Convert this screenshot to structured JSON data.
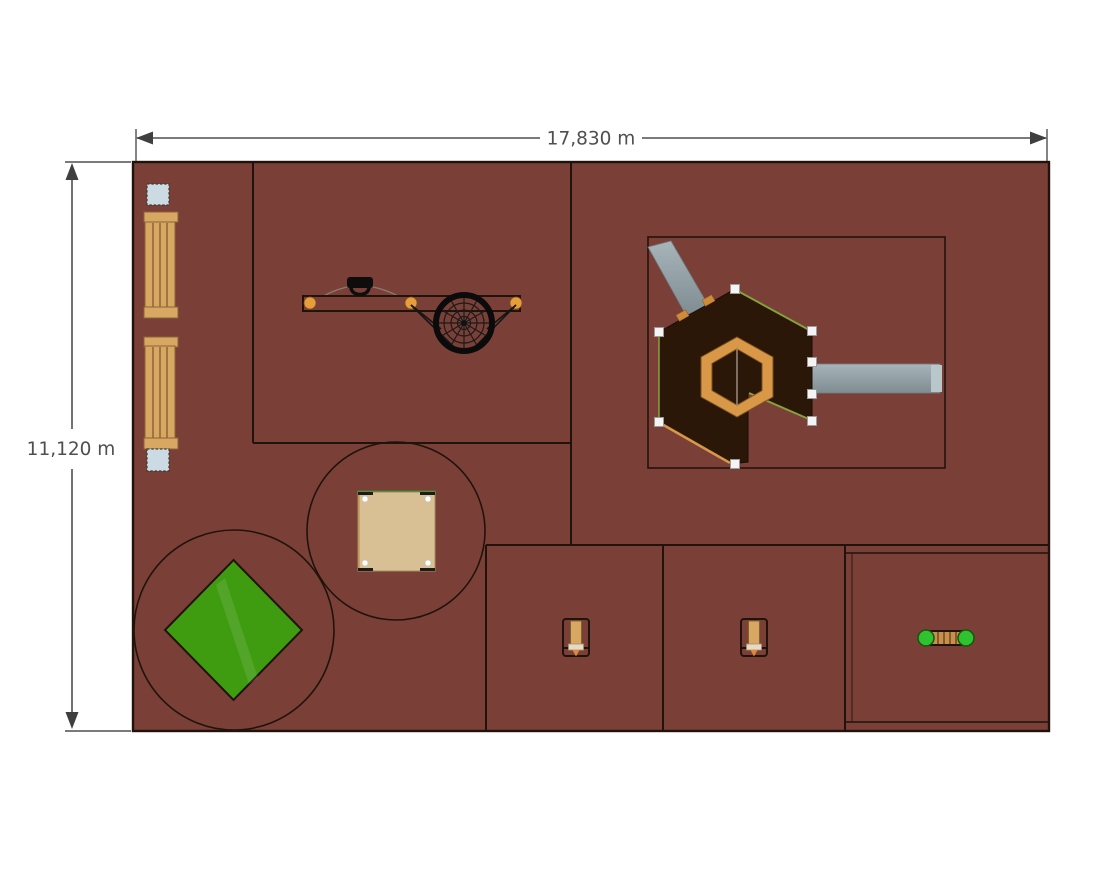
{
  "dimensions": {
    "width_label": "17,830 m",
    "height_label": "11,120 m"
  },
  "colors": {
    "ground": "#7a4037",
    "line": "#20130b",
    "dim": "#4f4f4f",
    "wood": "#d8a862",
    "wood-dark": "#8a6539",
    "sand": "#d8bf94",
    "grass": "#3f9b10",
    "platform": "#2b1708",
    "ring": "#d89848",
    "slide": "#93a2a8",
    "post": "#f4f4f4",
    "orange": "#e79d3b",
    "bright-green": "#2fc32f",
    "cube": "#ccdbe3",
    "trim-green": "#86a23a"
  },
  "equipment": {
    "bench": "bench-icon",
    "cube_seat": "cube-seat-icon",
    "swing_beam": "swing-beam-icon",
    "spider_wheel": "spider-wheel-icon",
    "hex_structure": "hex-tower-slides-icon",
    "sandbox": "sandbox-icon",
    "climbing_net": "climbing-net-icon",
    "spring_rider": "spring-rider-icon",
    "wobble_bar": "wobble-bar-icon"
  }
}
